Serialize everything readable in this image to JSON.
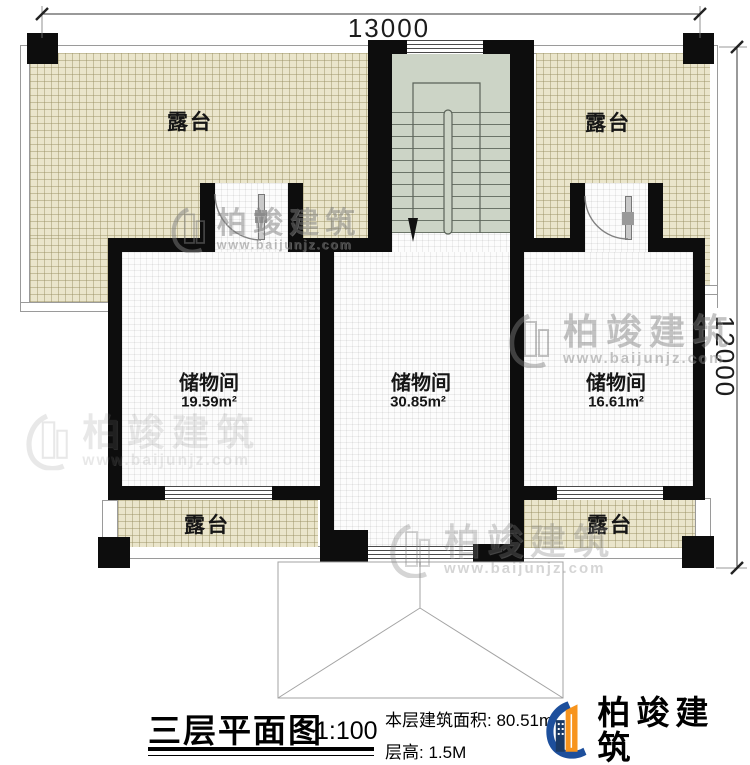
{
  "plan": {
    "dimensions": {
      "width_top": "13000",
      "height_right": "12000"
    },
    "terrace_label": "露台",
    "rooms": [
      {
        "name": "储物间",
        "area": "19.59m²"
      },
      {
        "name": "储物间",
        "area": "30.85m²"
      },
      {
        "name": "储物间",
        "area": "16.61m²"
      }
    ]
  },
  "title_block": {
    "title": "三层平面图",
    "scale": "1:100",
    "area_label": "本层建筑面积:",
    "area_value": "80.51m²",
    "height_label": "层高:",
    "height_value": "1.5M"
  },
  "brand": {
    "name": "柏竣建筑",
    "website": "www.baijunjz.com"
  },
  "watermark": {
    "name": "柏竣建筑",
    "website": "www.baijunjz.com"
  },
  "colors": {
    "terrace": "#eae5cb",
    "floor": "#fcfcfc",
    "stair": "#ccd4c6",
    "wall": "#0d0d0d",
    "logo_blue": "#1d4f9c",
    "logo_orange": "#f7941d",
    "logo_navy": "#1a3a66"
  }
}
